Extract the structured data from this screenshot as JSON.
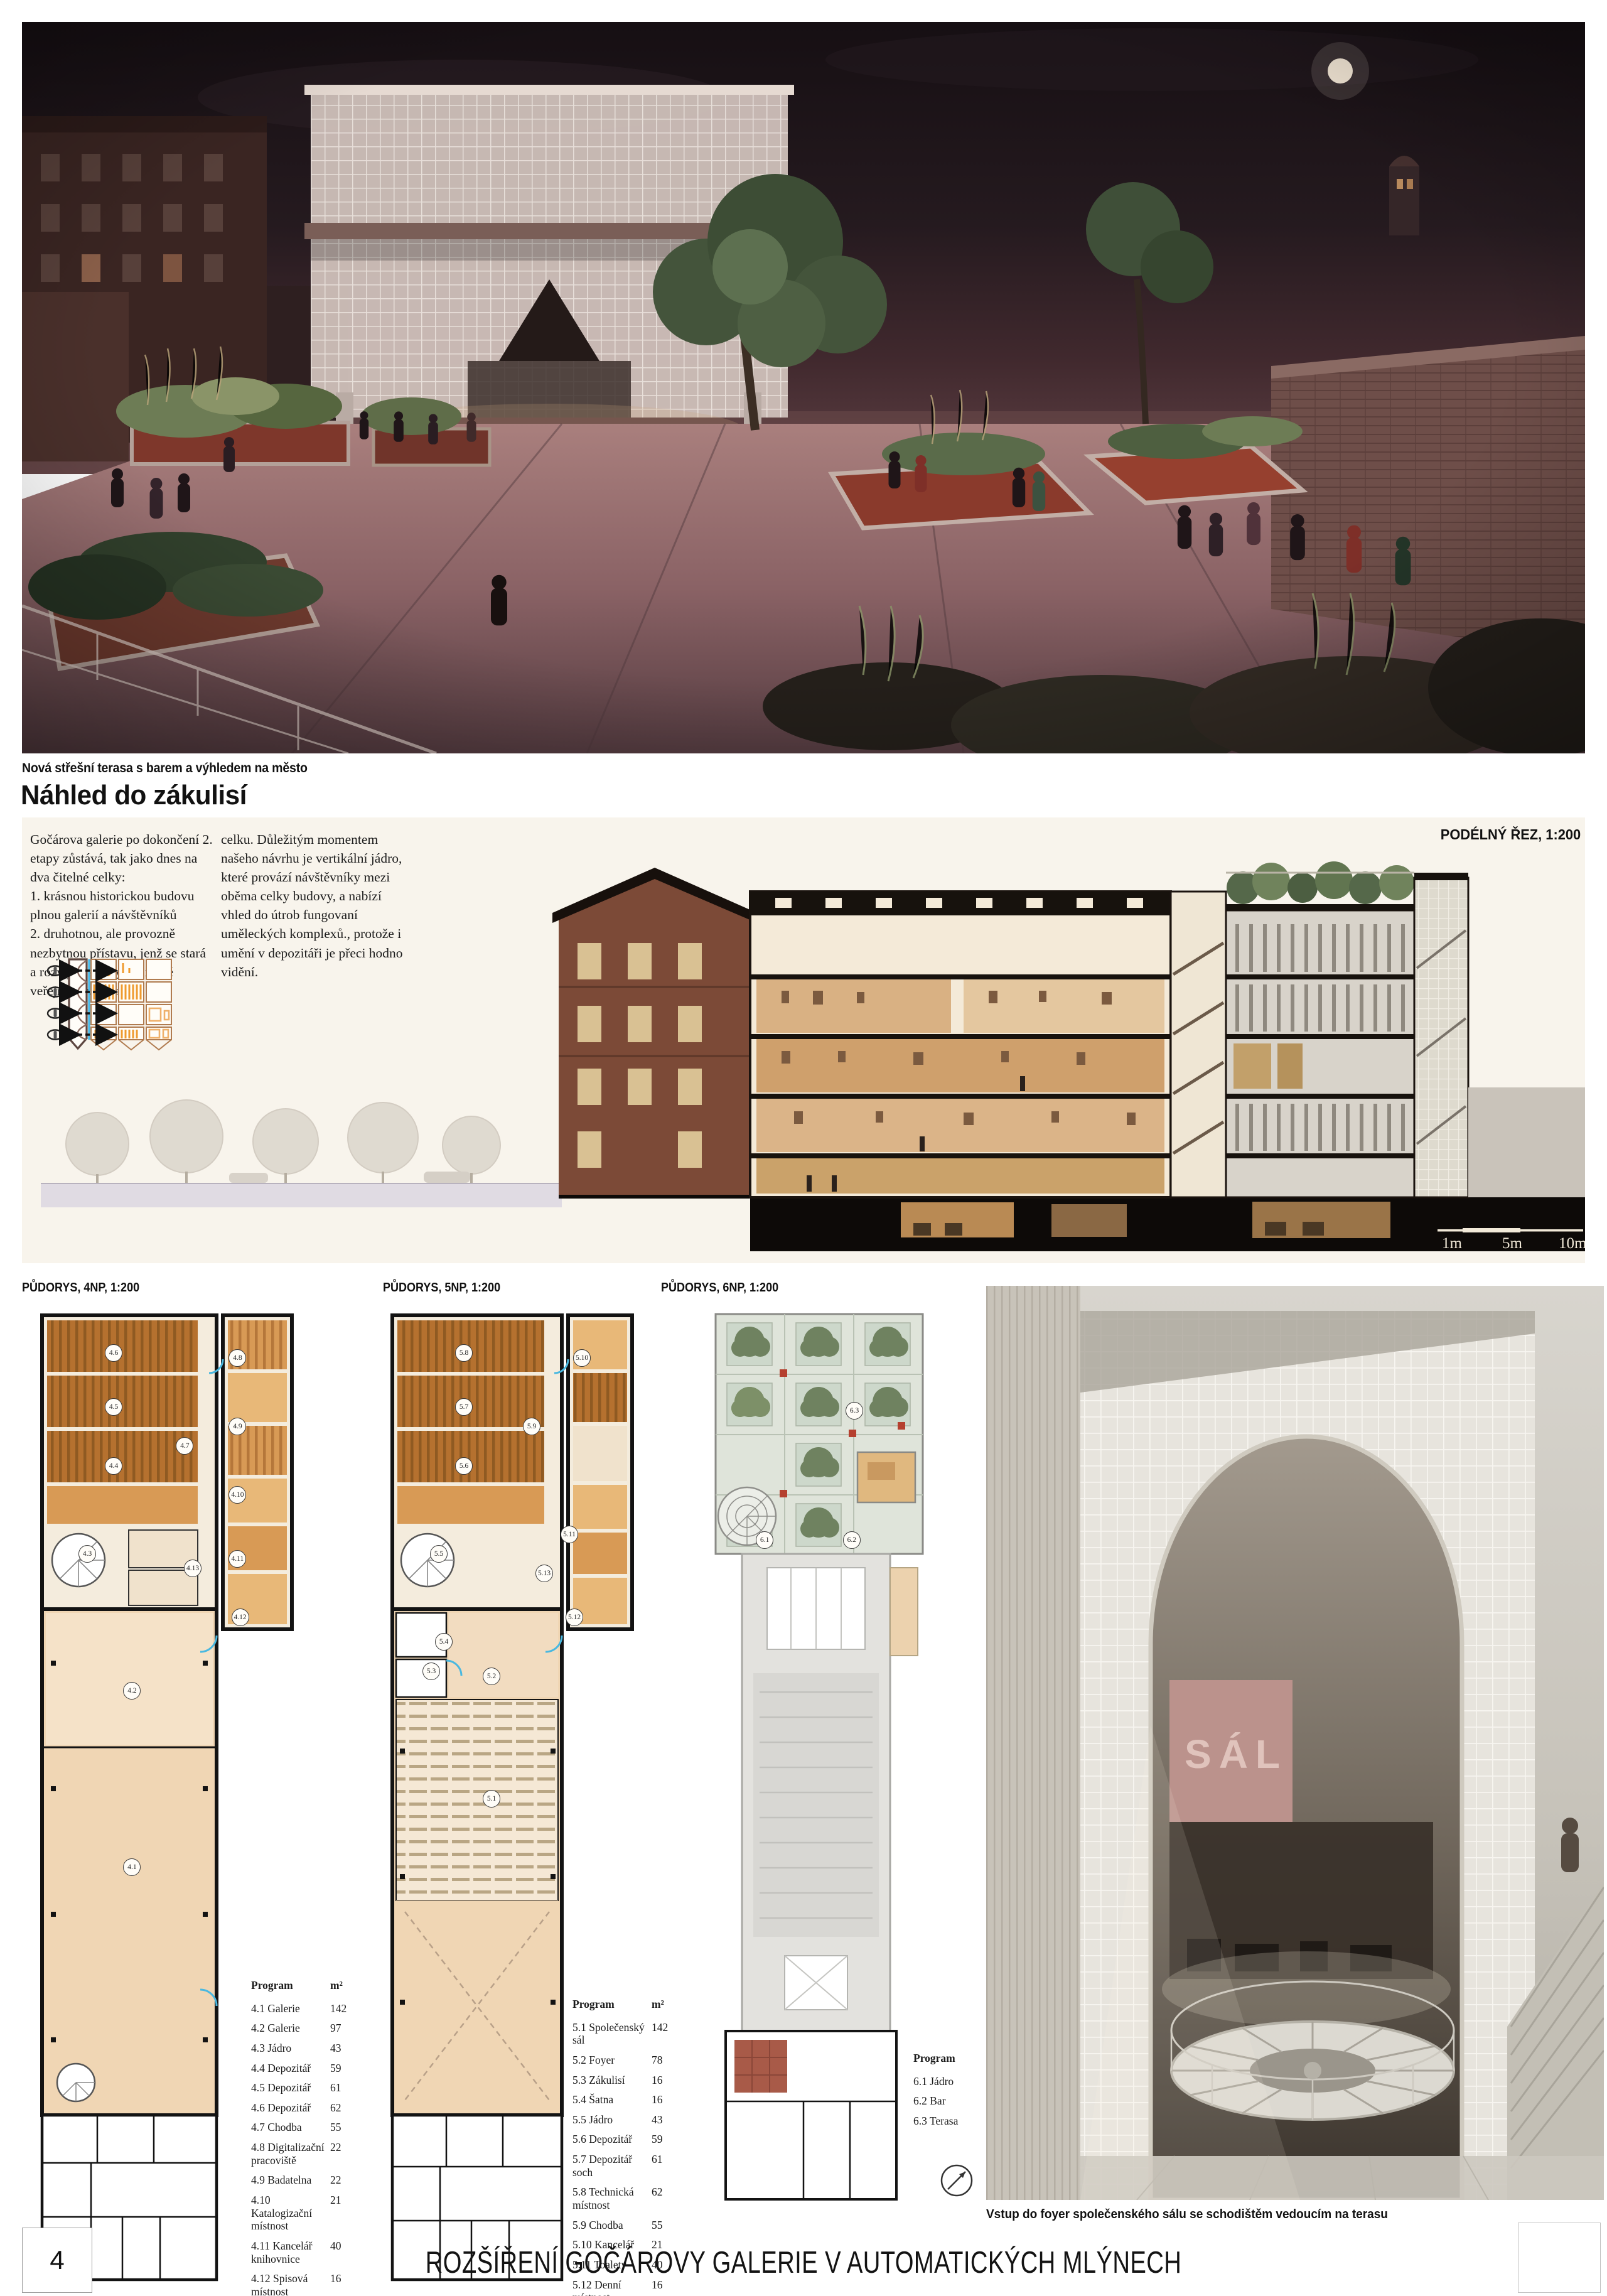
{
  "page": {
    "number": "4",
    "title": "ROZŠÍŘENÍ GOČÁROVY GALERIE V AUTOMATICKÝCH MLÝNECH"
  },
  "hero": {
    "caption": "Nová střešní terasa s barem a výhledem na město"
  },
  "backstage": {
    "heading": "Náhled do zákulisí",
    "col1": "Gočárova galerie po dokončení 2. etapy zůstává, tak jako dnes na dva čitelné celky:\n1. krásnou historickou budovu plnou galerií a návštěvníků\n2. druhotnou, ale provozně nezbytnou přístavu, jenž se stará a rozvíjí o sbírky nabízené veřejnosti v prvním",
    "col2": "celku. Důležitým momentem našeho návrhu je vertikální jádro, které provází návštěvníky mezi oběma celky budovy, a nabízí vhled do útrob fungovaní uměleckých komplexů., protože i umění v depozitáři je přeci hodno vidění.",
    "section_label": "PODÉLNÝ ŘEZ, 1:200",
    "scale_labels": [
      "1m",
      "5m",
      "10m"
    ]
  },
  "plans": [
    {
      "label": "PŮDORYS, 4NP, 1:200",
      "table": {
        "header": [
          "Program",
          "m²"
        ],
        "rows": [
          [
            "4.1 Galerie",
            "142"
          ],
          [
            "4.2 Galerie",
            "97"
          ],
          [
            "4.3 Jádro",
            "43"
          ],
          [
            "4.4 Depozitář",
            "59"
          ],
          [
            "4.5 Depozitář",
            "61"
          ],
          [
            "4.6 Depozitář",
            "62"
          ],
          [
            "4.7 Chodba",
            "55"
          ],
          [
            "4.8 Digitalizační pracoviště",
            "22"
          ],
          [
            "4.9 Badatelna",
            "22"
          ],
          [
            "4.10 Katalogizační místnost",
            "21"
          ],
          [
            "4.11 Kancelář knihovnice",
            "40"
          ],
          [
            "4.12 Spisová místnost",
            "16"
          ],
          [
            "4.13 Sklad výstavní techniky",
            "25"
          ]
        ]
      },
      "tags": [
        {
          "t": "4.6",
          "x": 30,
          "y": 4.5
        },
        {
          "t": "4.8",
          "x": 77,
          "y": 5
        },
        {
          "t": "4.5",
          "x": 30,
          "y": 10
        },
        {
          "t": "4.9",
          "x": 77,
          "y": 12
        },
        {
          "t": "4.4",
          "x": 30,
          "y": 16
        },
        {
          "t": "4.10",
          "x": 77,
          "y": 19
        },
        {
          "t": "4.7",
          "x": 57,
          "y": 14
        },
        {
          "t": "4.3",
          "x": 20,
          "y": 25
        },
        {
          "t": "4.13",
          "x": 60,
          "y": 26.5
        },
        {
          "t": "4.11",
          "x": 77,
          "y": 25.5
        },
        {
          "t": "4.12",
          "x": 78,
          "y": 31.5
        },
        {
          "t": "4.2",
          "x": 37,
          "y": 39
        },
        {
          "t": "4.1",
          "x": 37,
          "y": 57
        }
      ]
    },
    {
      "label": "PŮDORYS, 5NP, 1:200",
      "table": {
        "header": [
          "Program",
          "m²"
        ],
        "rows": [
          [
            "5.1 Společenský sál",
            "142"
          ],
          [
            "5.2 Foyer",
            "78"
          ],
          [
            "5.3 Zákulisí",
            "16"
          ],
          [
            "5.4 Šatna",
            "16"
          ],
          [
            "5.5 Jádro",
            "43"
          ],
          [
            "5.6 Depozitář",
            "59"
          ],
          [
            "5.7 Depozitář soch",
            "61"
          ],
          [
            "5.8 Technická místnost",
            "62"
          ],
          [
            "5.9 Chodba",
            "55"
          ],
          [
            "5.10 Kancelář",
            "21"
          ],
          [
            "5.11 Toalety",
            "40"
          ],
          [
            "5.12 Denní místnost",
            "16"
          ],
          [
            "5.13 Hovorna",
            "25"
          ]
        ]
      },
      "tags": [
        {
          "t": "5.8",
          "x": 31,
          "y": 4.5
        },
        {
          "t": "5.10",
          "x": 78,
          "y": 5
        },
        {
          "t": "5.7",
          "x": 31,
          "y": 10
        },
        {
          "t": "5.9",
          "x": 58,
          "y": 12
        },
        {
          "t": "5.6",
          "x": 31,
          "y": 16
        },
        {
          "t": "5.11",
          "x": 73,
          "y": 23
        },
        {
          "t": "5.5",
          "x": 21,
          "y": 25
        },
        {
          "t": "5.13",
          "x": 63,
          "y": 27
        },
        {
          "t": "5.12",
          "x": 75,
          "y": 31.5
        },
        {
          "t": "5.4",
          "x": 23,
          "y": 34
        },
        {
          "t": "5.3",
          "x": 18,
          "y": 37
        },
        {
          "t": "5.2",
          "x": 42,
          "y": 37.5
        },
        {
          "t": "5.1",
          "x": 42,
          "y": 50
        }
      ]
    },
    {
      "label": "PŮDORYS, 6NP, 1:200",
      "table": {
        "header": [
          "Program",
          "m²"
        ],
        "rows": [
          [
            "6.1 Jádro",
            "43"
          ],
          [
            "6.2 Bar",
            "26"
          ],
          [
            "6.3 Terasa",
            "363"
          ]
        ]
      },
      "tags": [
        {
          "t": "6.3",
          "x": 55,
          "y": 11
        },
        {
          "t": "6.1",
          "x": 21,
          "y": 25
        },
        {
          "t": "6.2",
          "x": 54,
          "y": 25
        }
      ]
    }
  ],
  "stair": {
    "wall_text": "SÁL",
    "caption": "Vstup do foyer společenského sálu se schodištěm vedoucím na terasu"
  }
}
